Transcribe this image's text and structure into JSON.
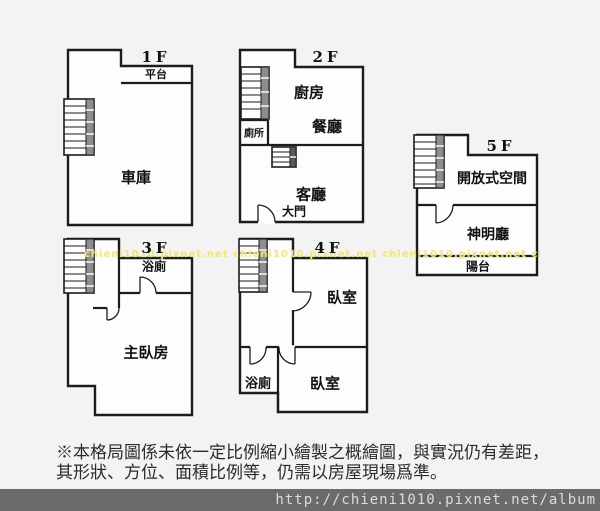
{
  "page": {
    "background": "#f3f3f3",
    "wall_color": "#1c1c1c",
    "plan_fill": "#fdfdfd"
  },
  "floors": {
    "f1": {
      "label": "1F",
      "rooms": {
        "platform": "平台",
        "garage": "車庫"
      }
    },
    "f2": {
      "label": "2F",
      "rooms": {
        "kitchen": "廚房",
        "dining": "餐廳",
        "toilet": "廁所",
        "living": "客廳",
        "main_door": "大門"
      }
    },
    "f3": {
      "label": "3F",
      "rooms": {
        "bath": "浴廁",
        "master_bedroom": "主臥房"
      }
    },
    "f4": {
      "label": "4F",
      "rooms": {
        "bedroom_upper": "臥室",
        "bath": "浴廁",
        "bedroom_lower": "臥室"
      }
    },
    "f5": {
      "label": "5F",
      "rooms": {
        "open_space": "開放式空間",
        "shrine_hall": "神明廳",
        "balcony": "陽台"
      }
    }
  },
  "watermark": {
    "text": "chieni1010.pixnet.net  chieni1010.pixnet.net  chieni1010.pixnet.net  chieni1010.pixnet.net  chieni1010.pixnet.net",
    "color": "#efe683"
  },
  "disclaimer": {
    "line1": "※本格局圖係未依一定比例縮小繪製之概繪圖，與實況仍有差距，",
    "line2": "其形狀、方位、面積比例等，仍需以房屋現場爲準。"
  },
  "footer": {
    "url": "http://chieni1010.pixnet.net/album",
    "background": "#6b6b6b",
    "text_color": "#dcdcdc"
  }
}
